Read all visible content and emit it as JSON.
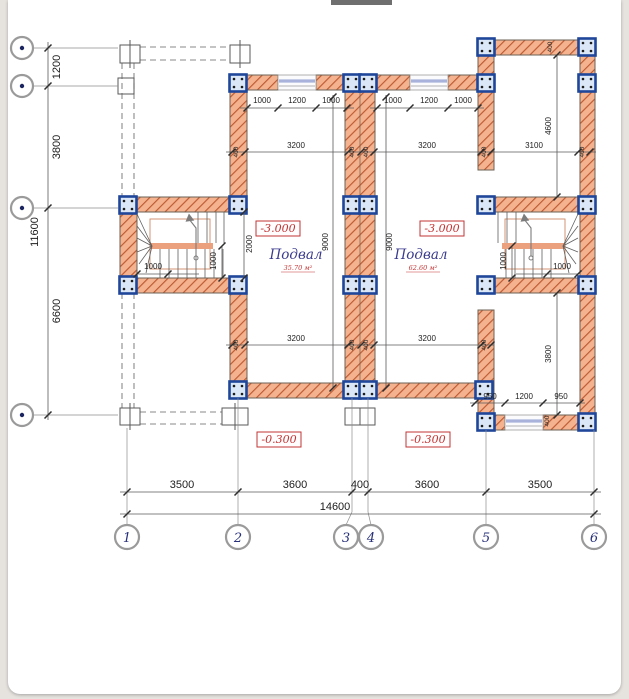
{
  "sheet": {
    "background": "#ffffff",
    "page_background": "#e6e3df"
  },
  "drawing": {
    "axis_numbers": [
      "1",
      "2",
      "3",
      "4",
      "5",
      "6"
    ],
    "bottom_dims": [
      "3500",
      "3600",
      "400",
      "3600",
      "3500"
    ],
    "bottom_total": "14600",
    "left_dims": [
      "1200",
      "3800",
      "6600"
    ],
    "left_total": "11600",
    "window_dims_top_left": [
      "1000",
      "1200",
      "1000"
    ],
    "window_dims_top_right": [
      "1000",
      "1200",
      "1000"
    ],
    "window_dims_bottom_right": [
      "950",
      "1200",
      "950"
    ],
    "room_width": "3200",
    "room_width_upper_right": "3100",
    "room_depth": "9000",
    "right_top_depth": "4600",
    "right_bottom_depth": "3800",
    "stair_opening": "2000",
    "stair_step": "1000",
    "wall_thickness": "400",
    "rooms": {
      "left": {
        "level": "-3.000",
        "name": "Подвал",
        "area": "35.70 м²"
      },
      "right": {
        "level": "-3.000",
        "name": "Подвал",
        "area": "62.60 м²"
      }
    },
    "outside_levels": {
      "left": "-0.300",
      "right": "-0.300"
    }
  }
}
